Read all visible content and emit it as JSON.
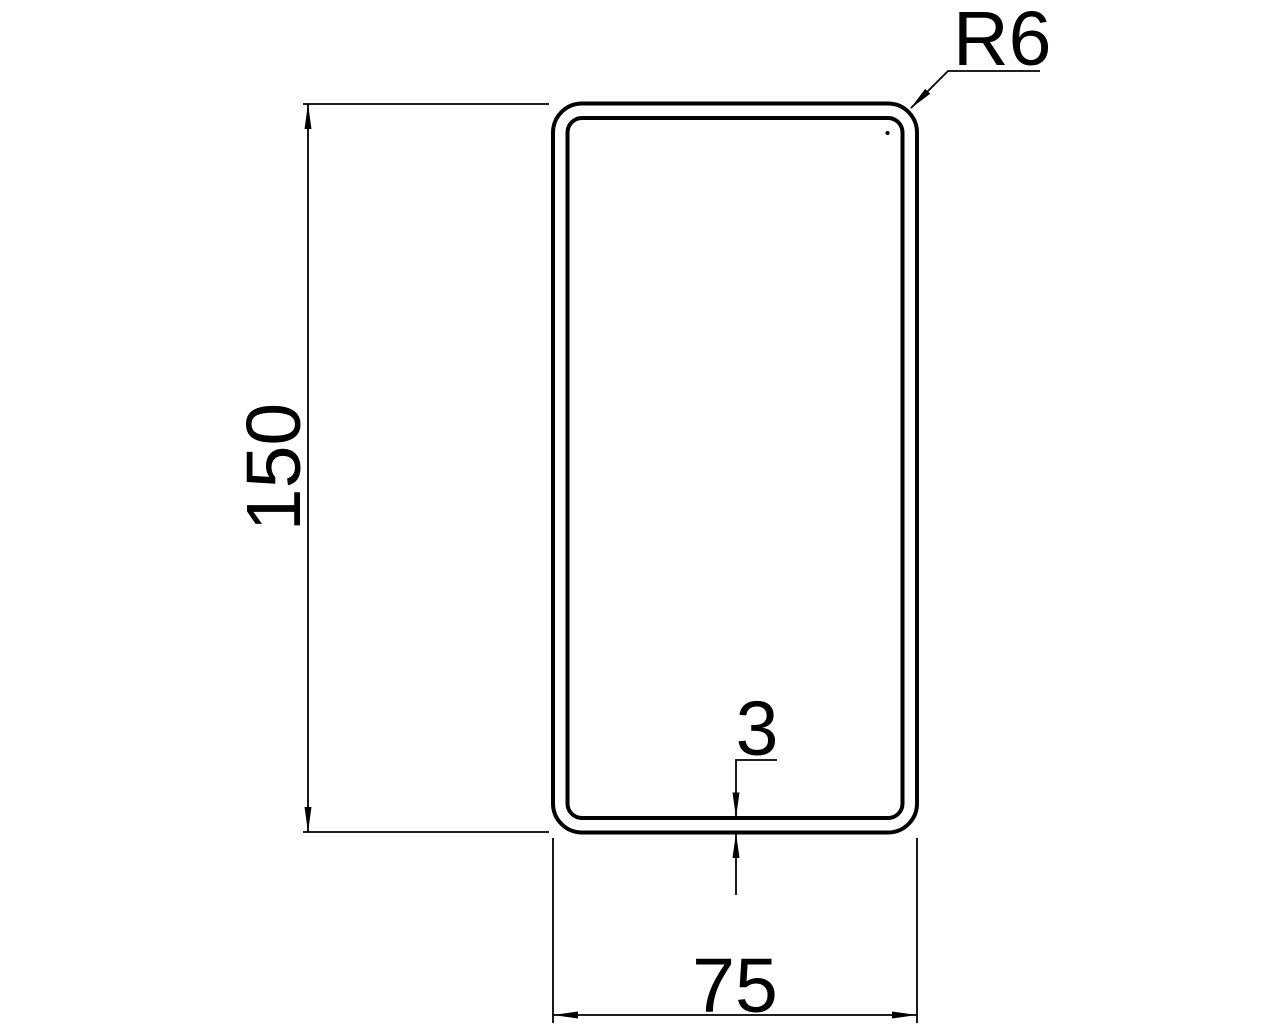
{
  "drawing": {
    "description": "Rectangular hollow section cross-section technical drawing",
    "colors": {
      "background": "#ffffff",
      "line": "#000000"
    },
    "labels": {
      "height": "150",
      "width": "75",
      "thickness": "3",
      "radius": "R6"
    }
  }
}
